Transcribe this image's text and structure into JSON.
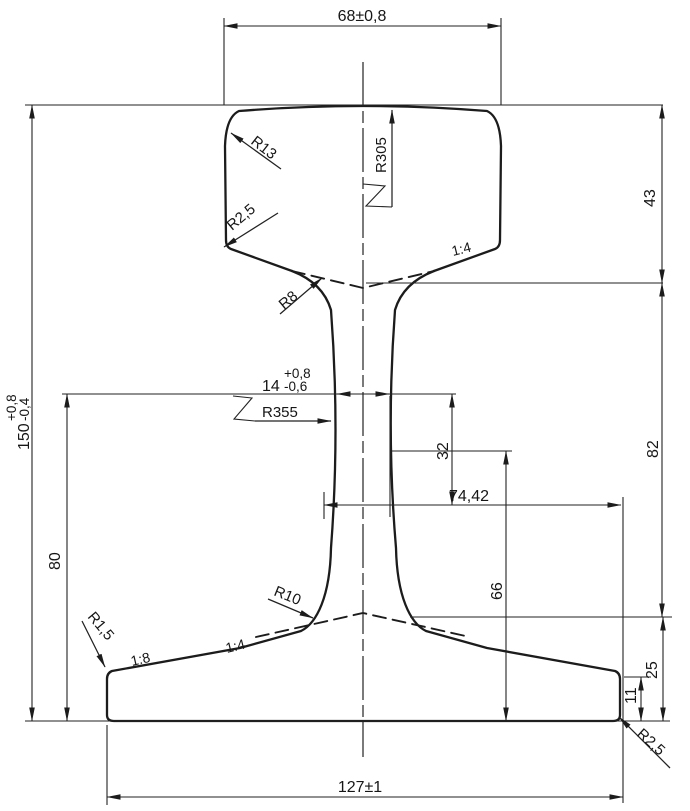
{
  "dims": {
    "head_width": "68±0,8",
    "height": "150",
    "height_plus": "+0,8",
    "height_minus": "-0,4",
    "head_depth": "43",
    "web_depth": "82",
    "foot_depth": "25",
    "foot_edge": "11",
    "web_mid": "80",
    "web_thk": "14",
    "web_thk_plus": "+0,8",
    "web_thk_minus": "-0,6",
    "web_lower": "32",
    "foot_flat": "74,42",
    "lower_height": "66",
    "foot_width": "127±1"
  },
  "radii": {
    "head_corner": "R13",
    "head_crown": "R305",
    "head_side": "R2,5",
    "head_web": "R8",
    "web": "R355",
    "web_foot": "R10",
    "foot_top": "R1,5",
    "foot_bottom": "R2,5"
  },
  "slopes": {
    "head_under": "1:4",
    "foot_inner": "1:4",
    "foot_outer": "1:8"
  },
  "colors": {
    "line": "#1c1c1c",
    "background": "#ffffff"
  }
}
